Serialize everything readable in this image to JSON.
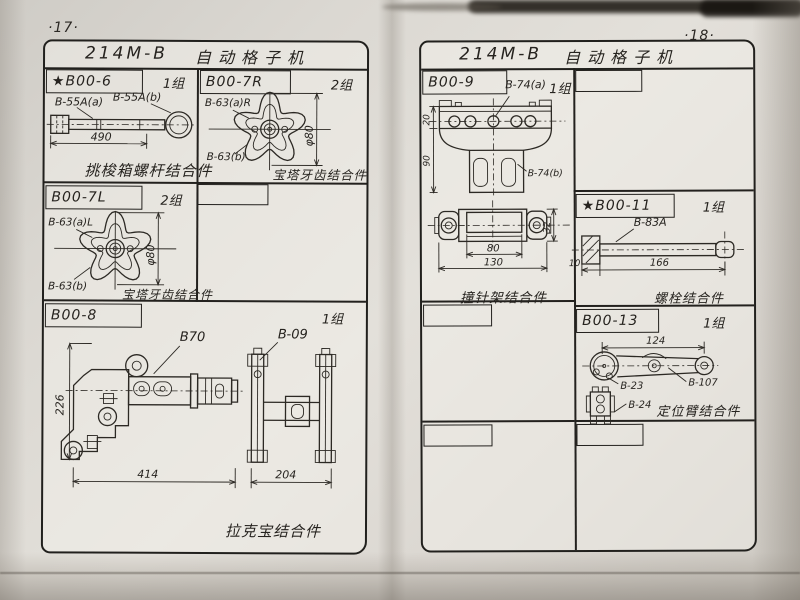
{
  "left": {
    "page_no": "·17·",
    "title": "214M-B",
    "subtitle": "自动格子机",
    "c6": {
      "label": "★B00-6",
      "group": "1组",
      "p1": "B-55A(a)",
      "p2": "B-55A(b)",
      "d490": "490",
      "caption": "挑梭箱螺杆结合件"
    },
    "c7r": {
      "label": "B00-7R",
      "group": "2组",
      "p1": "B-63(a)R",
      "p2": "B-63(b)",
      "dia": "φ80",
      "caption": "宝塔牙齿结合件"
    },
    "c7l": {
      "label": "B00-7L",
      "group": "2组",
      "p1": "B-63(a)L",
      "p2": "B-63(b)",
      "dia": "φ80",
      "caption": "宝塔牙齿结合件"
    },
    "c8": {
      "label": "B00-8",
      "group": "1组",
      "p1": "B70",
      "p2": "B-09",
      "d226": "226",
      "d414": "414",
      "d204": "204",
      "caption": "拉克宝结合件"
    }
  },
  "right": {
    "page_no": "·18·",
    "title": "214M-B",
    "subtitle": "自动格子机",
    "c9": {
      "label": "B00-9",
      "group": "1组",
      "p1": "B-74(a)",
      "p2": "B-74(b)",
      "d20": "20",
      "d90": "90",
      "d80": "80",
      "d130": "130",
      "d32": "32",
      "caption": "撞针架结合件"
    },
    "c11": {
      "label": "★B00-11",
      "group": "1组",
      "p1": "B-83A",
      "d10": "10",
      "d166": "166",
      "caption": "螺栓结合件"
    },
    "c13": {
      "label": "B00-13",
      "group": "1组",
      "p1": "B-23",
      "p2": "B-24",
      "p3": "B-107",
      "d124": "124",
      "caption": "定位臂结合件"
    }
  }
}
